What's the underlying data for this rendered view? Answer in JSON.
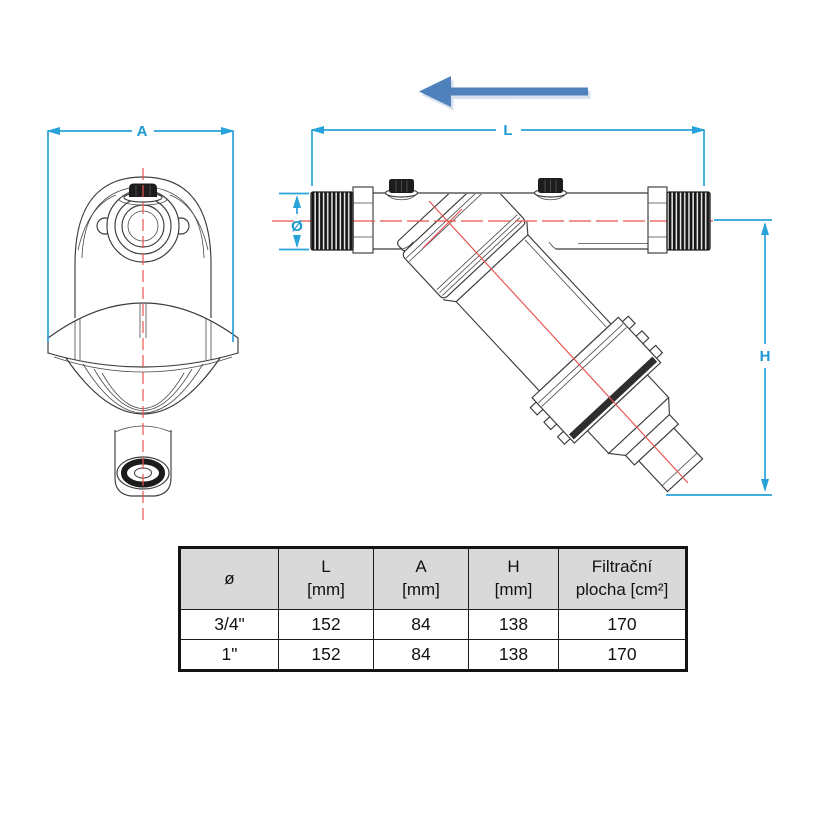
{
  "drawing": {
    "labels": {
      "a": "A",
      "l": "L",
      "diameter": "Ø",
      "h": "H"
    }
  },
  "table": {
    "headers": [
      {
        "l1": "ø",
        "l2": ""
      },
      {
        "l1": "L",
        "l2": "[mm]"
      },
      {
        "l1": "A",
        "l2": "[mm]"
      },
      {
        "l1": "H",
        "l2": "[mm]"
      },
      {
        "l1": "Filtrační",
        "l2": "plocha [cm²]"
      }
    ],
    "rows": [
      [
        "3/4\"",
        "152",
        "84",
        "138",
        "170"
      ],
      [
        "1\"",
        "152",
        "84",
        "138",
        "170"
      ]
    ]
  }
}
